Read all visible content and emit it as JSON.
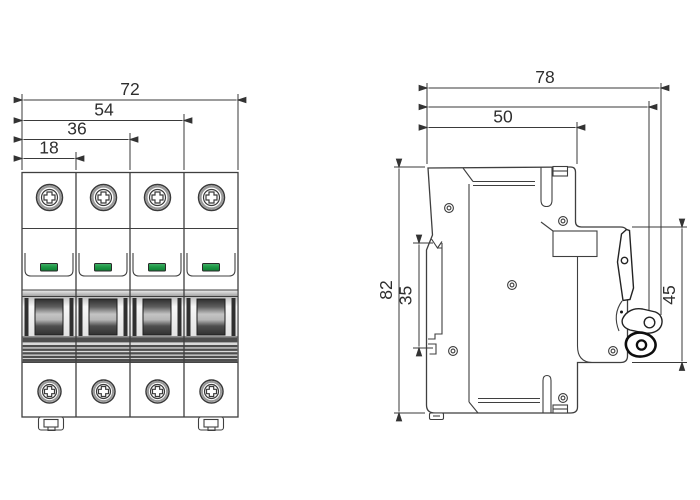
{
  "drawing": {
    "type": "engineering-dimension-drawing",
    "subject": "4-pole miniature circuit breaker",
    "units_shown": "mm"
  },
  "dims": {
    "front": {
      "total_width": "72",
      "width_three_poles": "54",
      "width_two_poles": "36",
      "width_one_pole": "18"
    },
    "side": {
      "total_depth": "78",
      "depth_to_lever": "74",
      "body_depth": "50",
      "height": "82",
      "din_slot_height": "35",
      "front_section_height": "45"
    }
  },
  "front_view": {
    "poles": 4,
    "top_screws": 4,
    "bottom_screws": 4,
    "indicator_windows": 4,
    "din_clips": 2
  },
  "side_view": {
    "rivets": 6,
    "has_toggle_lever": true,
    "has_din_channel": true
  },
  "colors": {
    "outline": "#3f3f3f",
    "dimension_line": "#3a3a3a",
    "indicator_green": "#1d9a46",
    "indicator_green_light": "#49b06c",
    "indicator_green_dark": "#0f7c33",
    "handle_dark": "#343434",
    "background": "#ffffff"
  }
}
